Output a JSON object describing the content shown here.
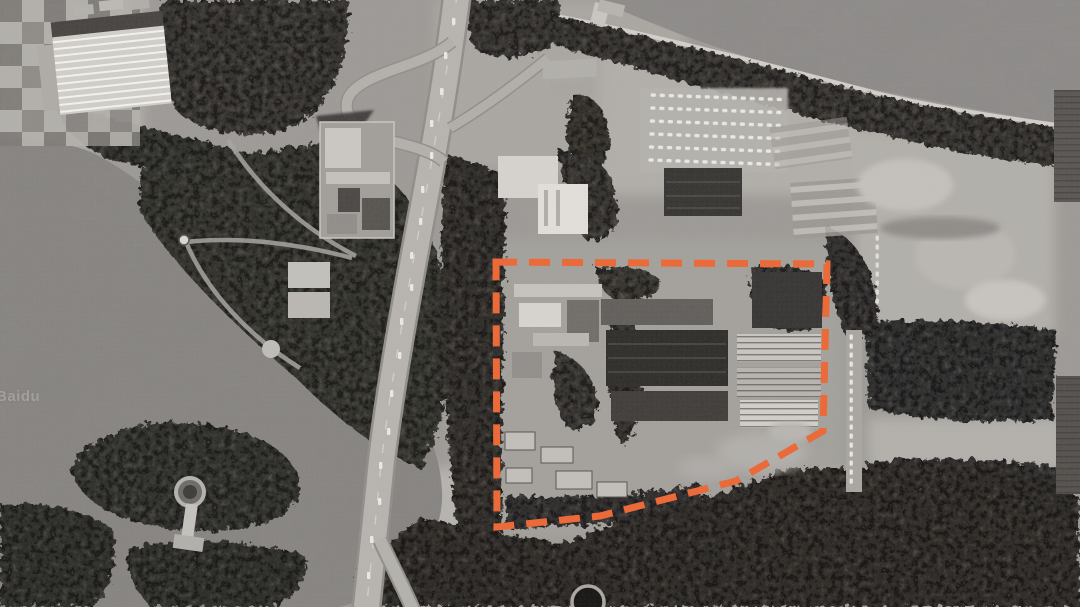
{
  "map": {
    "watermark": "Baidu",
    "view_type": "grayscale-satellite",
    "annotation": {
      "id": "site-boundary",
      "shape": "polygon",
      "style": "dashed",
      "color": "#EA6A3A",
      "stroke_width": 7,
      "dash_pattern": "21 12",
      "points": "496,262 827,264 823,431 736,481 600,516 497,527"
    }
  }
}
